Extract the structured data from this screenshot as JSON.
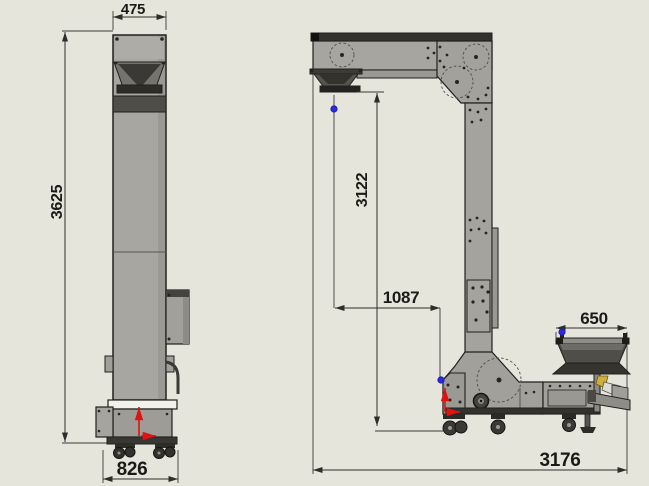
{
  "drawing": {
    "front_view": {
      "top_width": "475",
      "total_height": "3625",
      "base_width": "826"
    },
    "side_view": {
      "discharge_height": "3122",
      "discharge_offset": "1087",
      "infeed_width": "650",
      "overall_length": "3176"
    }
  },
  "colors": {
    "background": "#e6e5dc",
    "machine_gray": "#a8a6a1",
    "machine_dark": "#4b4a46",
    "band_dark": "#33322e",
    "outline": "#21201d",
    "dimension_line": "#2e2d29",
    "origin_arrow_red": "#e01212",
    "datum_point_blue": "#2b2bdd",
    "part_yellow": "#cfae3e"
  },
  "markers": {
    "datum_point": "blue-dot",
    "origin_marker": "red-axis-arrows"
  }
}
